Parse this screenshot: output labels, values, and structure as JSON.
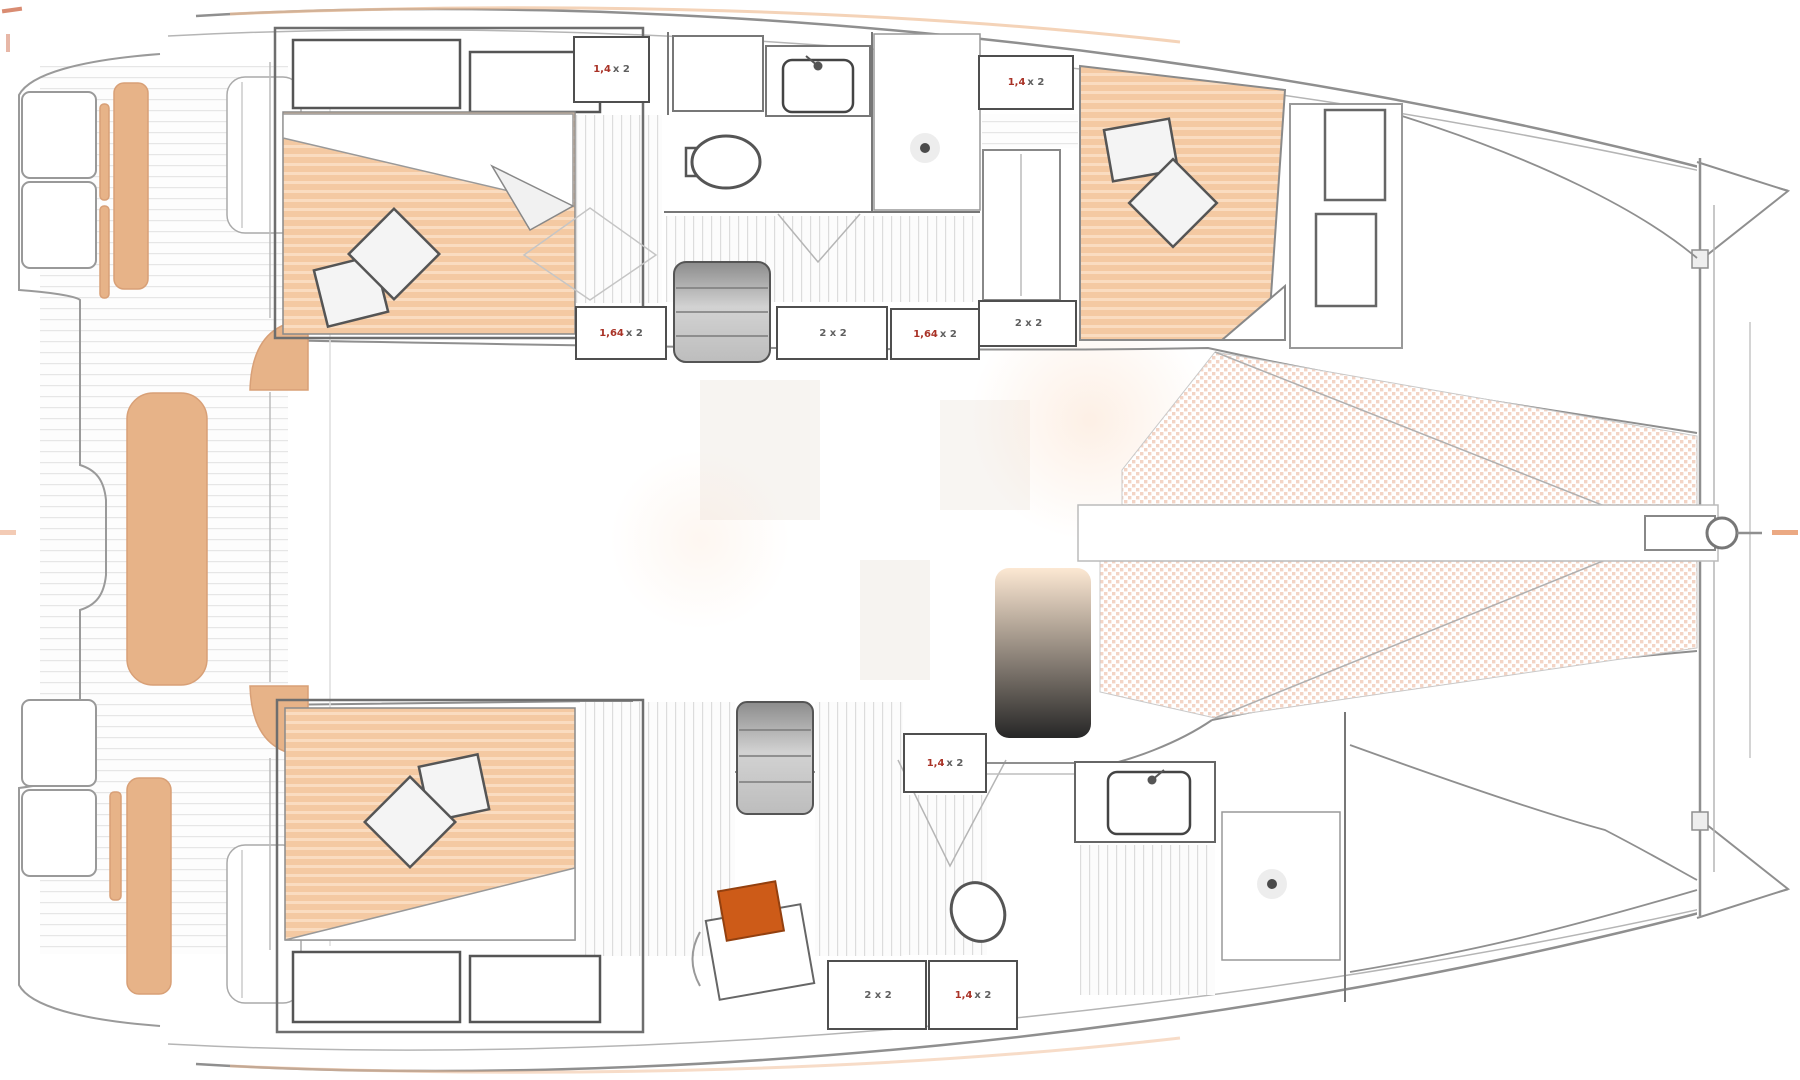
{
  "diagram": {
    "kind": "catamaran-deck-plan",
    "orientation": "bow-right-stern-left"
  },
  "colors": {
    "outline": "#8f8f8f",
    "furniture_stroke": "#5a5a5a",
    "mattress": "#f4c9a2",
    "mattress_stripe": "#fadcc0",
    "cushion": "#e7b388",
    "mesh_dot": "#efc5b1",
    "accent_orange": "#cd5b18",
    "label_red": "#a93226",
    "steps_gray": "#9a9a9a"
  },
  "fixtures": [
    "port-aft-berth",
    "port-forward-berth",
    "starboard-aft-berth",
    "port-head-toilet",
    "port-head-sink",
    "port-shower-drain",
    "starboard-head-toilet",
    "starboard-head-sink",
    "starboard-shower-drain",
    "companionway-steps-port",
    "companionway-steps-starboard",
    "cockpit-bench-cushions",
    "trampoline-net",
    "bowsprit-fitting",
    "office-stool",
    "office-desk"
  ],
  "dimension_labels": [
    {
      "name": "port-aft-berth-size",
      "red": "1,4",
      "main": "x 2"
    },
    {
      "name": "port-fwd-berth-size-top",
      "red": "1,4",
      "main": "x 2"
    },
    {
      "name": "port-mid-size-left",
      "red": "1,64",
      "main": "x 2"
    },
    {
      "name": "port-mid-size-center",
      "red": "",
      "main": "2 x 2"
    },
    {
      "name": "port-mid-size-right",
      "red": "1,64",
      "main": "x 2"
    },
    {
      "name": "port-fwd-berth-size-btm",
      "red": "",
      "main": "2 x 2"
    },
    {
      "name": "stbd-mid-berth-size",
      "red": "1,4",
      "main": "x 2"
    },
    {
      "name": "stbd-aft-size-left",
      "red": "",
      "main": "2 x 2"
    },
    {
      "name": "stbd-aft-size-right",
      "red": "1,4",
      "main": "x 2"
    }
  ]
}
